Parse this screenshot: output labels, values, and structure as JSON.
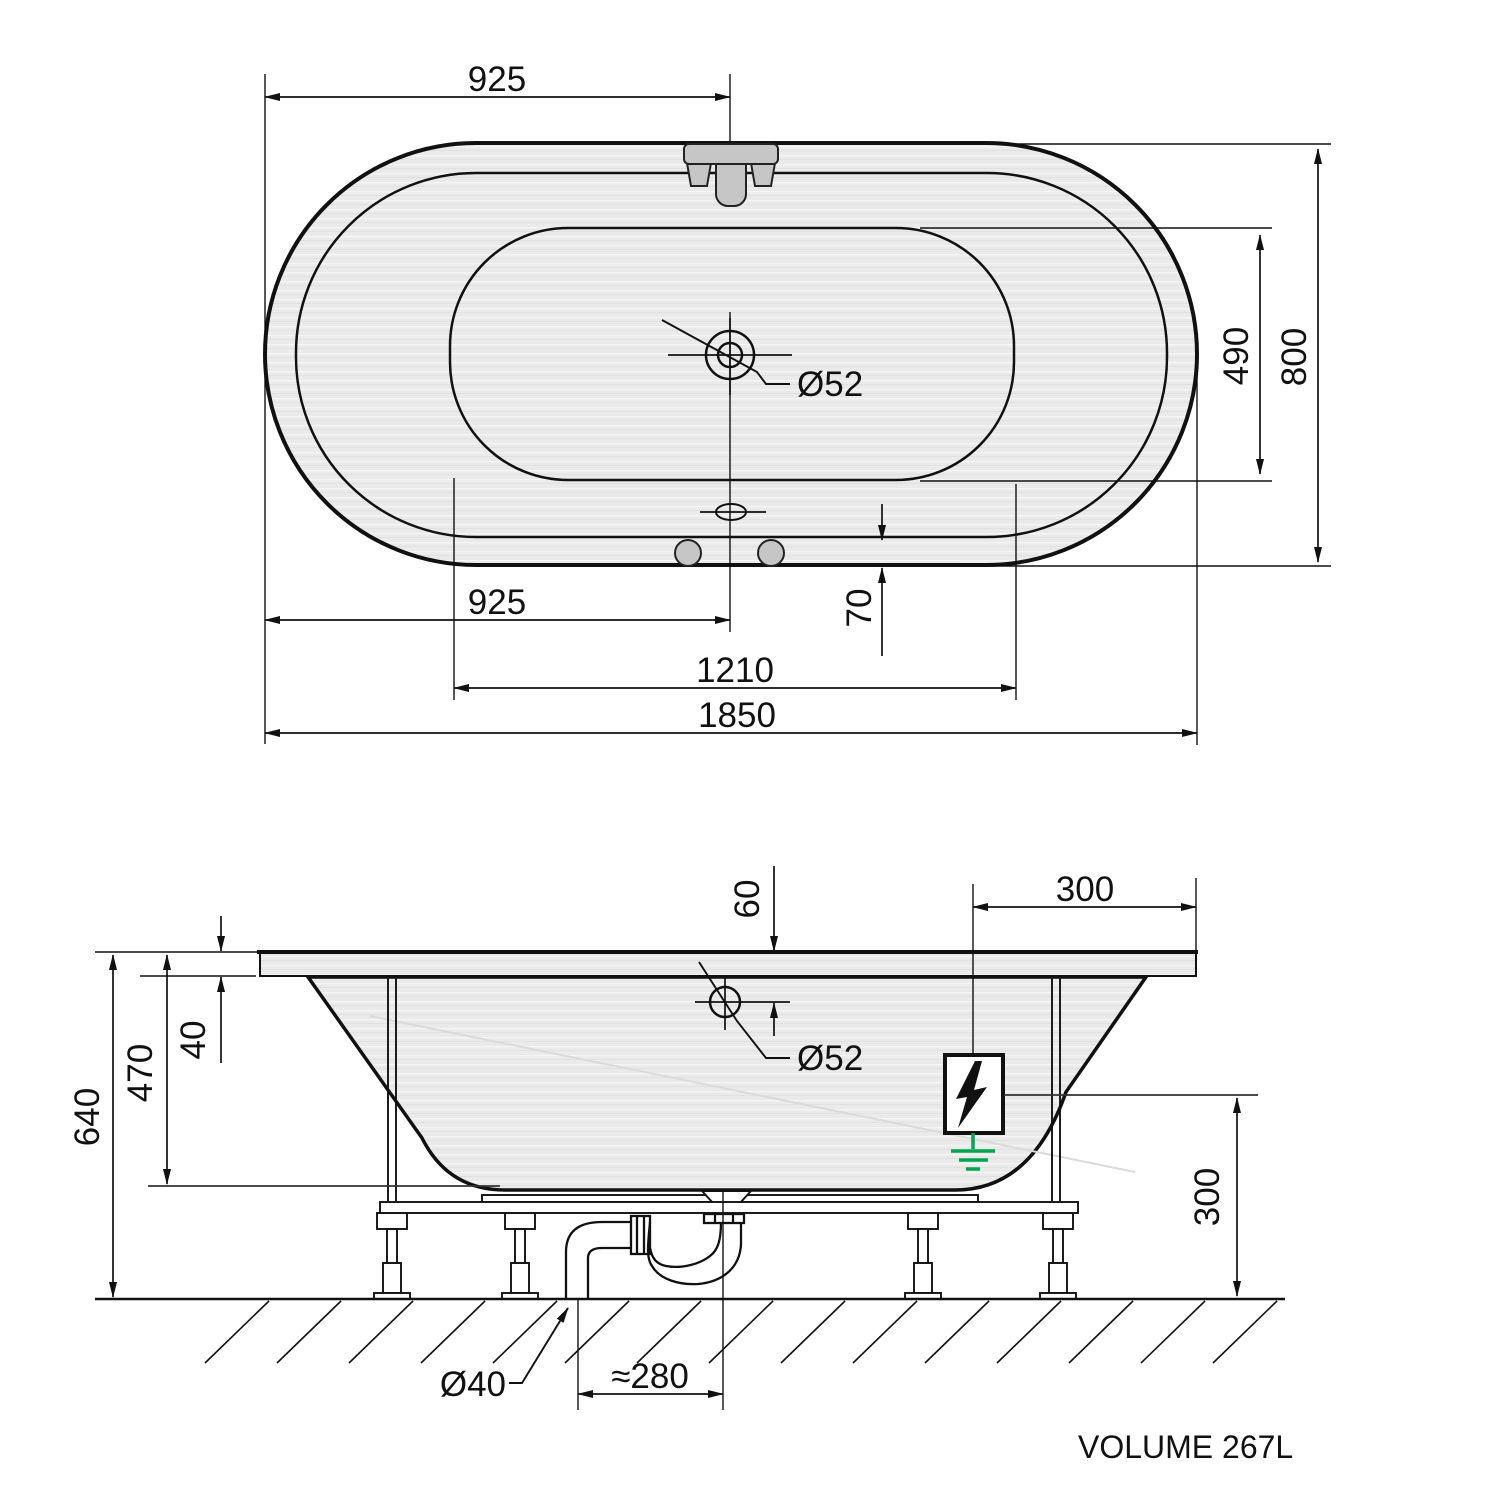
{
  "page": {
    "background": "#ffffff",
    "description": "Oval bathtub technical installation drawing, top view and side view"
  },
  "colors": {
    "line": "#111111",
    "tub_fill": "#eaeaea",
    "fixture_fill": "#c6c6c6",
    "ground_green": "#00a651"
  },
  "top_view": {
    "labels": {
      "faucet_offset_top": "925",
      "drain_offset_bottom": "925",
      "inner_length": "1210",
      "overall_length": "1850",
      "overall_width": "800",
      "inner_width": "490",
      "edge_offset": "70",
      "drain_diameter": "Ø52"
    },
    "icons": {
      "faucet": "faucet-icon",
      "drain": "drain-icon",
      "overflow": "overflow-icon",
      "jets": "jet-hole-icon"
    }
  },
  "side_view": {
    "labels": {
      "overflow_from_rim": "60",
      "rim_thickness": "40",
      "inner_depth": "470",
      "overall_height": "640",
      "electrical_inset": "300",
      "electrical_height": "300",
      "overflow_diameter": "Ø52",
      "waste_pipe_diameter": "Ø40",
      "trap_offset": "≈280"
    },
    "icons": {
      "electrical": "lightning-bolt-icon",
      "earth": "earth-ground-icon",
      "siphon": "siphon-icon"
    }
  },
  "footer": {
    "volume_label": "VOLUME 267L"
  }
}
